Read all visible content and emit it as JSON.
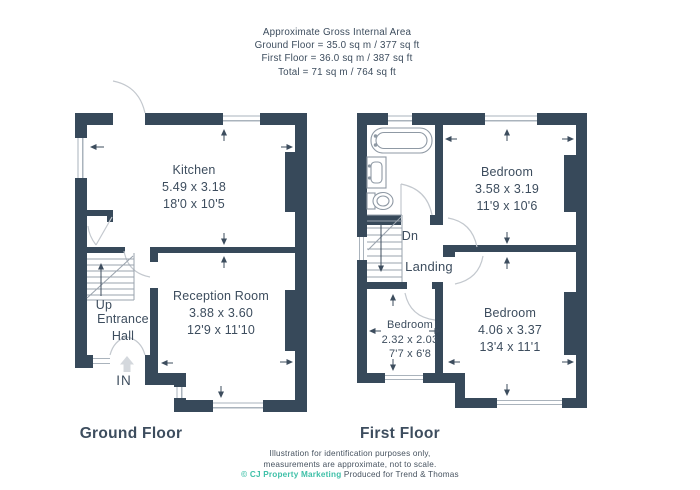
{
  "header": {
    "line1": "Approximate Gross Internal Area",
    "line2": "Ground Floor = 35.0 sq m / 377 sq ft",
    "line3": "First Floor = 36.0 sq m / 387 sq ft",
    "line4": "Total = 71 sq m / 764 sq ft"
  },
  "ground_floor": {
    "label": "Ground Floor",
    "kitchen": {
      "name": "Kitchen",
      "metric": "5.49 x 3.18",
      "imperial": "18'0 x 10'5"
    },
    "reception": {
      "name": "Reception Room",
      "metric": "3.88 x 3.60",
      "imperial": "12'9 x 11'10"
    },
    "up": "Up",
    "entrance_line1": "Entrance",
    "entrance_line2": "Hall",
    "in_label": "IN"
  },
  "first_floor": {
    "label": "First Floor",
    "bedroom1": {
      "name": "Bedroom",
      "metric": "3.58 x 3.19",
      "imperial": "11'9 x 10'6"
    },
    "bedroom2": {
      "name": "Bedroom",
      "metric": "4.06 x 3.37",
      "imperial": "13'4 x 11'1"
    },
    "bedroom3": {
      "name": "Bedroom",
      "metric": "2.32 x 2.03",
      "imperial": "7'7 x 6'8"
    },
    "dn": "Dn",
    "landing": "Landing"
  },
  "footer": {
    "line1": "Illustration for identification purposes only,",
    "line2": "measurements are approximate, not to scale.",
    "credit": "© CJ Property Marketing",
    "produced": "Produced for Trend & Thomas"
  },
  "colors": {
    "wall": "#37495A",
    "text": "#3D4D5E",
    "credit_teal": "#3FC0A8"
  }
}
